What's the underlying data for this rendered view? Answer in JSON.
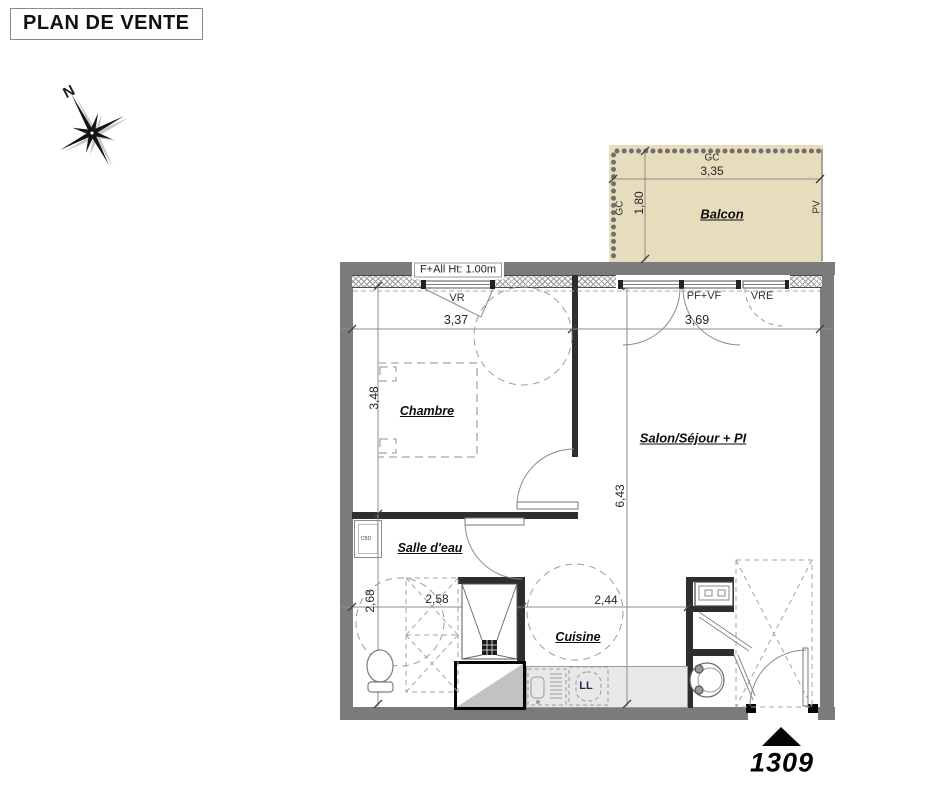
{
  "title": "PLAN DE VENTE",
  "compass": {
    "north": "N"
  },
  "balcony": {
    "label": "Balcon",
    "gc_top": "GC",
    "gc_left": "GC",
    "pv": "PV",
    "width": "3,35",
    "depth": "1,80"
  },
  "rooms": {
    "chambre": "Chambre",
    "salon": "Salon/Séjour + PI",
    "salle_deau": "Salle d'eau",
    "cuisine": "Cuisine"
  },
  "openings": {
    "window_note": "F+All Ht: 1.00m",
    "vr": "VR",
    "pf_vf": "PF+VF",
    "vre": "VRE"
  },
  "fixtures": {
    "cbd": "CBD",
    "ll": "LL"
  },
  "dims": {
    "chambre_w": "3,37",
    "salon_w": "3,69",
    "chambre_h": "3,48",
    "salon_h": "6,43",
    "salle_deau_h": "2,68",
    "salle_deau_w": "2,58",
    "cuisine_w": "2,44"
  },
  "lot_number": "1309",
  "colors": {
    "wall": "#7b7b7b",
    "interior_wall": "#2e2e2e",
    "balcony_fill": "#e7ddbd",
    "counter_fill": "#e8e8e8",
    "hatch_line": "#9b9b9b"
  }
}
